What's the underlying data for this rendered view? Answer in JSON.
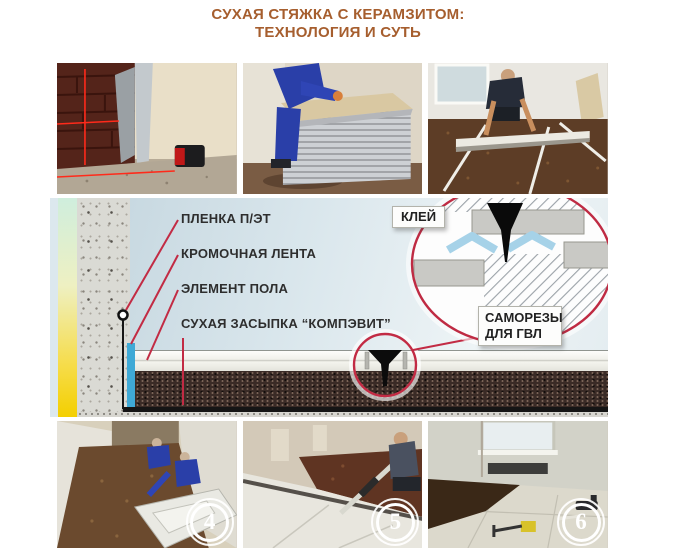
{
  "title": {
    "line1": "СУХАЯ СТЯЖКА С КЕРАМЗИТОМ:",
    "line2": "ТЕХНОЛОГИЯ И СУТЬ"
  },
  "colors": {
    "title_brown": "#a65e2e",
    "accent_red": "#c22b44",
    "edge_tape_blue": "#3fa9d6",
    "glue_blue": "#a6d2e8",
    "dry_fill_brown": "#3a2b26"
  },
  "diagram": {
    "labels": {
      "film": "ПЛЕНКА П/ЭТ",
      "edge_tape": "КРОМОЧНАЯ ЛЕНТА",
      "floor_element": "ЭЛЕМЕНТ ПОЛА",
      "dry_fill": "СУХАЯ ЗАСЫПКА “КОМПЭВИТ”",
      "glue": "КЛЕЙ",
      "screws": "САМОРЕЗЫ ДЛЯ ГВЛ"
    }
  },
  "photos": {
    "top": [
      {
        "desc": "Разметка уровня лазерным нивелиром"
      },
      {
        "desc": "Стопка элементов пола ГВЛ"
      },
      {
        "desc": "Выравнивание керамзита по маякам"
      }
    ],
    "bottom": [
      {
        "number": "4",
        "desc": "Укладка элементов пола"
      },
      {
        "number": "5",
        "desc": "Разравнивание засыпки правилом"
      },
      {
        "number": "6",
        "desc": "Смонтированный сборный пол"
      }
    ]
  }
}
